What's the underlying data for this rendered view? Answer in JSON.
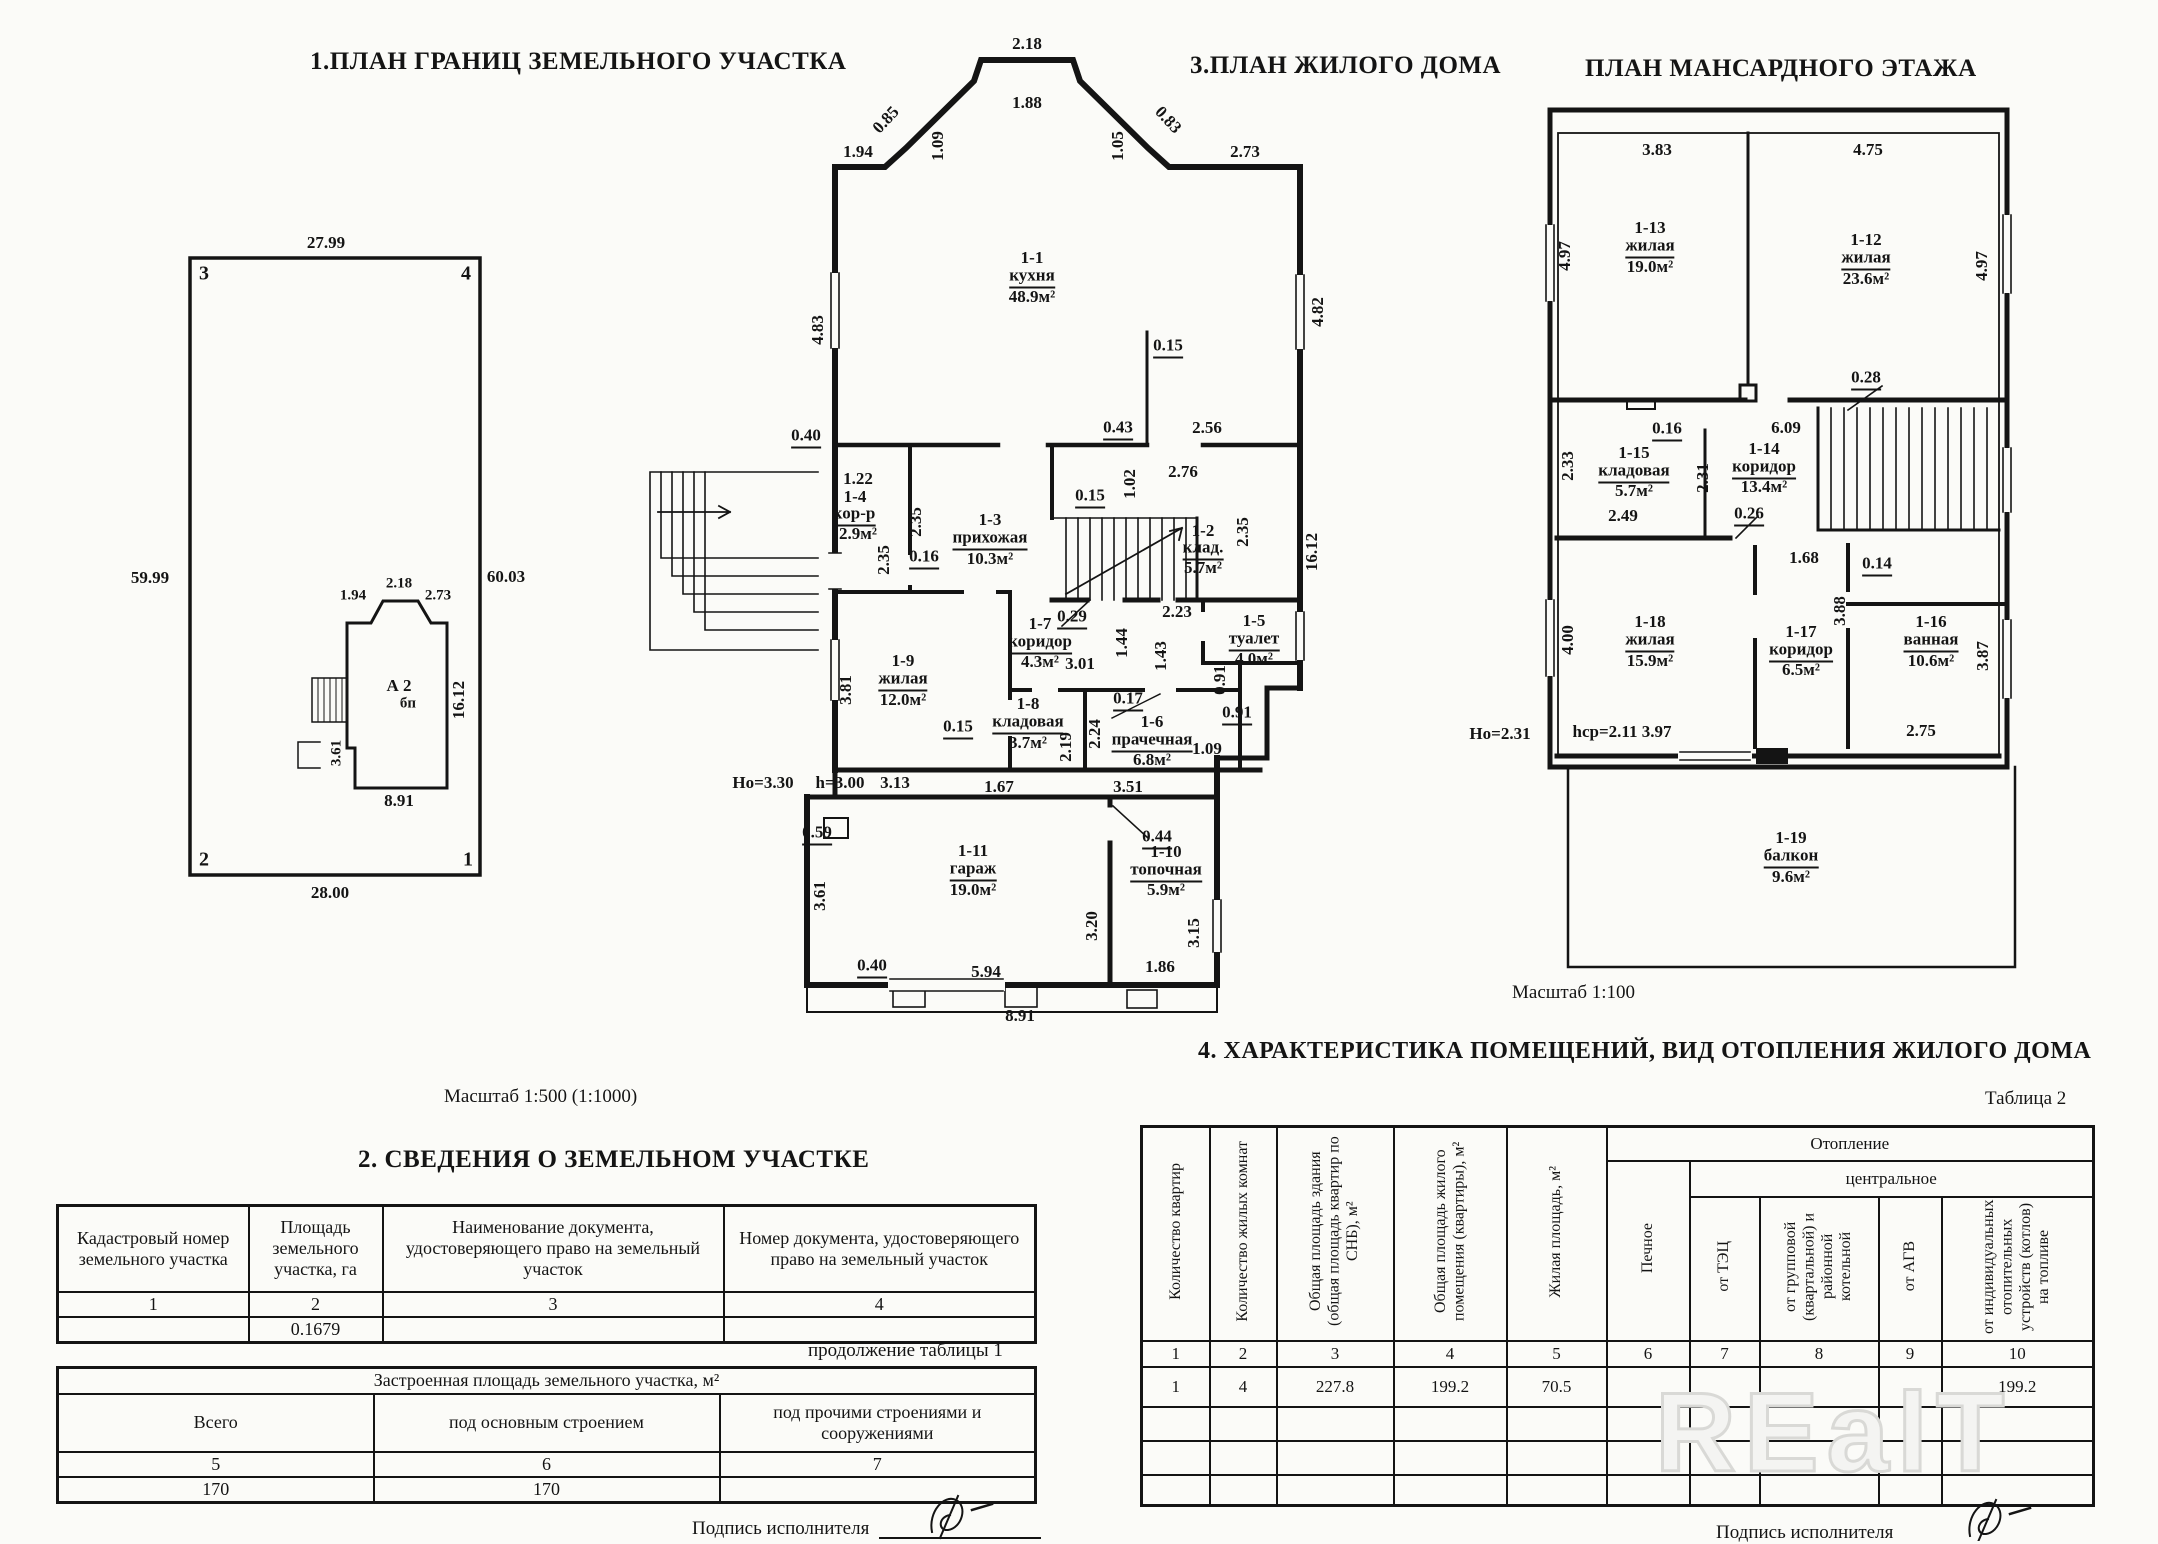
{
  "titles": {
    "plot": "1.ПЛАН ГРАНИЦ  ЗЕМЕЛЬНОГО УЧАСТКА",
    "house": "3.ПЛАН ЖИЛОГО ДОМА",
    "attic": "ПЛАН МАНСАРДНОГО ЭТАЖА",
    "land": "2. СВЕДЕНИЯ О ЗЕМЕЛЬНОМ УЧАСТКЕ",
    "rooms": "4. ХАРАКТЕРИСТИКА ПОМЕЩЕНИЙ, ВИД ОТОПЛЕНИЯ ЖИЛОГО ДОМА"
  },
  "notes": {
    "continuation": "продолжение таблицы 1",
    "table2": "Таблица 2"
  },
  "signature": {
    "label": "Подпись исполнителя"
  },
  "watermark": {
    "text": "REalT"
  },
  "plot_plan": {
    "scale_note": "Масштаб 1:500 (1:1000)",
    "labels": [
      {
        "t": "27.99",
        "x": 326,
        "y": 243
      },
      {
        "t": "3",
        "x": 204,
        "y": 274,
        "s": "lg"
      },
      {
        "t": "4",
        "x": 466,
        "y": 274,
        "s": "lg"
      },
      {
        "t": "59.99",
        "x": 150,
        "y": 578
      },
      {
        "t": "60.03",
        "x": 506,
        "y": 577
      },
      {
        "t": "2",
        "x": 204,
        "y": 860,
        "s": "lg"
      },
      {
        "t": "1",
        "x": 468,
        "y": 860,
        "s": "lg"
      },
      {
        "t": "28.00",
        "x": 330,
        "y": 893
      },
      {
        "t": "1.94",
        "x": 353,
        "y": 596,
        "s": "sm"
      },
      {
        "t": "2.18",
        "x": 399,
        "y": 584,
        "s": "sm"
      },
      {
        "t": "2.73",
        "x": 438,
        "y": 596,
        "s": "sm"
      },
      {
        "t": "А 2",
        "x": 399,
        "y": 686
      },
      {
        "t": "бп",
        "x": 408,
        "y": 704,
        "s": "sm"
      },
      {
        "t": "16.12",
        "x": 459,
        "y": 700,
        "r": -90
      },
      {
        "t": "3.61",
        "x": 337,
        "y": 753,
        "r": -90,
        "s": "sm"
      },
      {
        "t": "8.91",
        "x": 399,
        "y": 801
      }
    ]
  },
  "main_plan": {
    "labels": [
      {
        "t": "2.18",
        "x": 1027,
        "y": 44
      },
      {
        "t": "1.88",
        "x": 1027,
        "y": 103
      },
      {
        "t": "0.85",
        "x": 886,
        "y": 120,
        "r": -47
      },
      {
        "t": "1.09",
        "x": 938,
        "y": 146,
        "r": -90
      },
      {
        "t": "1.94",
        "x": 858,
        "y": 152
      },
      {
        "t": "0.83",
        "x": 1168,
        "y": 120,
        "r": 47
      },
      {
        "t": "1.05",
        "x": 1118,
        "y": 146,
        "r": -90
      },
      {
        "t": "2.73",
        "x": 1245,
        "y": 152
      },
      {
        "t": "4.83",
        "x": 818,
        "y": 330,
        "r": -90
      },
      {
        "t": "4.82",
        "x": 1318,
        "y": 312,
        "r": -90
      },
      {
        "t": "1-1",
        "x": 1032,
        "y": 258
      },
      {
        "t": "кухня",
        "x": 1032,
        "y": 277,
        "u": 1
      },
      {
        "t": "48.9м²",
        "x": 1032,
        "y": 297
      },
      {
        "t": "0.15",
        "x": 1168,
        "y": 347,
        "u": 1
      },
      {
        "t": "0.43",
        "x": 1118,
        "y": 429,
        "u": 1
      },
      {
        "t": "2.56",
        "x": 1207,
        "y": 428
      },
      {
        "t": "0.40",
        "x": 806,
        "y": 437,
        "u": 1
      },
      {
        "t": "1.22",
        "x": 858,
        "y": 479
      },
      {
        "t": "1-4",
        "x": 855,
        "y": 497
      },
      {
        "t": "кор-р",
        "x": 854,
        "y": 515,
        "u": 1
      },
      {
        "t": "2.9м²",
        "x": 858,
        "y": 534
      },
      {
        "t": "2.35",
        "x": 916,
        "y": 522,
        "r": -90
      },
      {
        "t": "2.35",
        "x": 884,
        "y": 560,
        "r": -90
      },
      {
        "t": "0.16",
        "x": 924,
        "y": 558,
        "u": 1
      },
      {
        "t": "1-3",
        "x": 990,
        "y": 520
      },
      {
        "t": "прихожая",
        "x": 990,
        "y": 539,
        "u": 1
      },
      {
        "t": "10.3м²",
        "x": 990,
        "y": 559
      },
      {
        "t": "0.15",
        "x": 1090,
        "y": 497,
        "u": 1
      },
      {
        "t": "1.02",
        "x": 1130,
        "y": 484,
        "r": -90
      },
      {
        "t": "2.76",
        "x": 1183,
        "y": 472
      },
      {
        "t": "1-2",
        "x": 1203,
        "y": 531
      },
      {
        "t": "клад.",
        "x": 1203,
        "y": 549,
        "u": 1
      },
      {
        "t": "5.7м²",
        "x": 1203,
        "y": 568
      },
      {
        "t": "2.35",
        "x": 1243,
        "y": 532,
        "r": -90
      },
      {
        "t": "16.12",
        "x": 1312,
        "y": 552,
        "r": -90
      },
      {
        "t": "0.29",
        "x": 1072,
        "y": 618,
        "u": 1
      },
      {
        "t": "2.23",
        "x": 1177,
        "y": 612
      },
      {
        "t": "1.44",
        "x": 1122,
        "y": 643,
        "r": -90
      },
      {
        "t": "1.43",
        "x": 1161,
        "y": 656,
        "r": -90
      },
      {
        "t": "1-5",
        "x": 1254,
        "y": 621
      },
      {
        "t": "туалет",
        "x": 1254,
        "y": 640,
        "u": 1
      },
      {
        "t": "4.0м²",
        "x": 1254,
        "y": 659
      },
      {
        "t": "1-7",
        "x": 1040,
        "y": 624
      },
      {
        "t": "коридор",
        "x": 1040,
        "y": 643,
        "u": 1
      },
      {
        "t": "4.3м²",
        "x": 1040,
        "y": 662
      },
      {
        "t": "3.01",
        "x": 1080,
        "y": 664
      },
      {
        "t": "1-9",
        "x": 903,
        "y": 661
      },
      {
        "t": "жилая",
        "x": 903,
        "y": 680,
        "u": 1
      },
      {
        "t": "12.0м²",
        "x": 903,
        "y": 700
      },
      {
        "t": "3.81",
        "x": 846,
        "y": 690,
        "r": -90
      },
      {
        "t": "0.15",
        "x": 958,
        "y": 728,
        "u": 1
      },
      {
        "t": "1-8",
        "x": 1028,
        "y": 704
      },
      {
        "t": "кладовая",
        "x": 1028,
        "y": 723,
        "u": 1
      },
      {
        "t": "3.7м²",
        "x": 1028,
        "y": 743
      },
      {
        "t": "0.17",
        "x": 1128,
        "y": 700,
        "u": 1
      },
      {
        "t": "2.24",
        "x": 1095,
        "y": 734,
        "r": -90
      },
      {
        "t": "2.19",
        "x": 1066,
        "y": 747,
        "r": -90
      },
      {
        "t": "1-6",
        "x": 1152,
        "y": 722
      },
      {
        "t": "прачечная",
        "x": 1152,
        "y": 741,
        "u": 1
      },
      {
        "t": "6.8м²",
        "x": 1152,
        "y": 760
      },
      {
        "t": "0.91",
        "x": 1220,
        "y": 680,
        "r": -90
      },
      {
        "t": "0.91",
        "x": 1237,
        "y": 714,
        "u": 1
      },
      {
        "t": "1.09",
        "x": 1207,
        "y": 749
      },
      {
        "t": "Но=3.30",
        "x": 763,
        "y": 783
      },
      {
        "t": "h=3.00",
        "x": 840,
        "y": 783
      },
      {
        "t": "3.13",
        "x": 895,
        "y": 783
      },
      {
        "t": "1.67",
        "x": 999,
        "y": 787
      },
      {
        "t": "3.51",
        "x": 1128,
        "y": 787
      },
      {
        "t": "0.59",
        "x": 817,
        "y": 834,
        "u": 1
      },
      {
        "t": "3.61",
        "x": 820,
        "y": 896,
        "r": -90
      },
      {
        "t": "1-11",
        "x": 973,
        "y": 851
      },
      {
        "t": "гараж",
        "x": 973,
        "y": 870,
        "u": 1
      },
      {
        "t": "19.0м²",
        "x": 973,
        "y": 890
      },
      {
        "t": "3.20",
        "x": 1092,
        "y": 926,
        "r": -90
      },
      {
        "t": "0.44",
        "x": 1157,
        "y": 838,
        "u": 1
      },
      {
        "t": "1-10",
        "x": 1166,
        "y": 852
      },
      {
        "t": "топочная",
        "x": 1166,
        "y": 871,
        "u": 1
      },
      {
        "t": "5.9м²",
        "x": 1166,
        "y": 890
      },
      {
        "t": "3.15",
        "x": 1194,
        "y": 933,
        "r": -90
      },
      {
        "t": "0.40",
        "x": 872,
        "y": 967,
        "u": 1
      },
      {
        "t": "5.94",
        "x": 986,
        "y": 972
      },
      {
        "t": "1.86",
        "x": 1160,
        "y": 967
      },
      {
        "t": "8.91",
        "x": 1020,
        "y": 1016
      }
    ]
  },
  "attic_plan": {
    "scale_note": "Масштаб 1:100",
    "labels": [
      {
        "t": "3.83",
        "x": 1657,
        "y": 150
      },
      {
        "t": "4.75",
        "x": 1868,
        "y": 150
      },
      {
        "t": "4.97",
        "x": 1565,
        "y": 256,
        "r": -90
      },
      {
        "t": "4.97",
        "x": 1982,
        "y": 266,
        "r": -90
      },
      {
        "t": "1-13",
        "x": 1650,
        "y": 228
      },
      {
        "t": "жилая",
        "x": 1650,
        "y": 247,
        "u": 1
      },
      {
        "t": "19.0м²",
        "x": 1650,
        "y": 267
      },
      {
        "t": "1-12",
        "x": 1866,
        "y": 240
      },
      {
        "t": "жилая",
        "x": 1866,
        "y": 259,
        "u": 1
      },
      {
        "t": "23.6м²",
        "x": 1866,
        "y": 279
      },
      {
        "t": "0.28",
        "x": 1866,
        "y": 379,
        "u": 1
      },
      {
        "t": "6.09",
        "x": 1786,
        "y": 428
      },
      {
        "t": "0.16",
        "x": 1667,
        "y": 430,
        "u": 1
      },
      {
        "t": "2.33",
        "x": 1568,
        "y": 466,
        "r": -90
      },
      {
        "t": "1-15",
        "x": 1634,
        "y": 453
      },
      {
        "t": "кладовая",
        "x": 1634,
        "y": 472,
        "u": 1
      },
      {
        "t": "5.7м²",
        "x": 1634,
        "y": 491
      },
      {
        "t": "2.31",
        "x": 1703,
        "y": 478,
        "r": -90
      },
      {
        "t": "1-14",
        "x": 1764,
        "y": 449
      },
      {
        "t": "коридор",
        "x": 1764,
        "y": 468,
        "u": 1
      },
      {
        "t": "13.4м²",
        "x": 1764,
        "y": 487
      },
      {
        "t": "2.49",
        "x": 1623,
        "y": 516
      },
      {
        "t": "0.26",
        "x": 1749,
        "y": 515,
        "u": 1
      },
      {
        "t": "1.68",
        "x": 1804,
        "y": 558
      },
      {
        "t": "0.14",
        "x": 1877,
        "y": 565,
        "u": 1
      },
      {
        "t": "3.88",
        "x": 1840,
        "y": 611,
        "r": -90
      },
      {
        "t": "4.00",
        "x": 1568,
        "y": 640,
        "r": -90
      },
      {
        "t": "1-18",
        "x": 1650,
        "y": 622
      },
      {
        "t": "жилая",
        "x": 1650,
        "y": 641,
        "u": 1
      },
      {
        "t": "15.9м²",
        "x": 1650,
        "y": 661
      },
      {
        "t": "1-17",
        "x": 1801,
        "y": 632
      },
      {
        "t": "коридор",
        "x": 1801,
        "y": 651,
        "u": 1
      },
      {
        "t": "6.5м²",
        "x": 1801,
        "y": 670
      },
      {
        "t": "1-16",
        "x": 1931,
        "y": 622
      },
      {
        "t": "ванная",
        "x": 1931,
        "y": 641,
        "u": 1
      },
      {
        "t": "10.6м²",
        "x": 1931,
        "y": 661
      },
      {
        "t": "3.87",
        "x": 1983,
        "y": 656,
        "r": -90
      },
      {
        "t": "Но=2.31",
        "x": 1500,
        "y": 734
      },
      {
        "t": "hср=2.11 3.97",
        "x": 1622,
        "y": 732
      },
      {
        "t": "2.75",
        "x": 1921,
        "y": 731
      },
      {
        "t": "1-19",
        "x": 1791,
        "y": 838
      },
      {
        "t": "балкон",
        "x": 1791,
        "y": 857,
        "u": 1
      },
      {
        "t": "9.6м²",
        "x": 1791,
        "y": 877
      }
    ]
  },
  "land_table": {
    "headers": [
      "Кадастровый номер земельного участка",
      "Площадь земельного участка, га",
      "Наименование документа, удостоверяющего право на земельный участок",
      "Номер документа, удостоверяющего право на земельный участок"
    ],
    "numbering": [
      "1",
      "2",
      "3",
      "4"
    ],
    "row": [
      "",
      "0.1679",
      "",
      ""
    ]
  },
  "built_area_table": {
    "title": "Застроенная площадь земельного участка, м²",
    "headers": [
      "Всего",
      "под основным строением",
      "под прочими строениями и сооружениями"
    ],
    "numbering": [
      "5",
      "6",
      "7"
    ],
    "row": [
      "170",
      "170",
      ""
    ]
  },
  "rooms_table": {
    "group_header": "Отопление",
    "subgroup_header": "центральное",
    "col_headers": [
      "Количество квартир",
      "Количество жилых комнат",
      "Общая площадь здания (общая площадь квартир по СНБ), м²",
      "Общая площадь жилого помещения (квартиры), м²",
      "Жилая площадь, м²",
      "Печное",
      "от ТЭЦ",
      "от групповой (квартальной) и районной котельной",
      "от АГВ",
      "от индивидуальных отопительных устройств (котлов) на топливе"
    ],
    "numbering": [
      "1",
      "2",
      "3",
      "4",
      "5",
      "6",
      "7",
      "8",
      "9",
      "10"
    ],
    "data_row": [
      "1",
      "4",
      "227.8",
      "199.2",
      "70.5",
      "",
      "",
      "",
      "",
      "199.2"
    ]
  }
}
